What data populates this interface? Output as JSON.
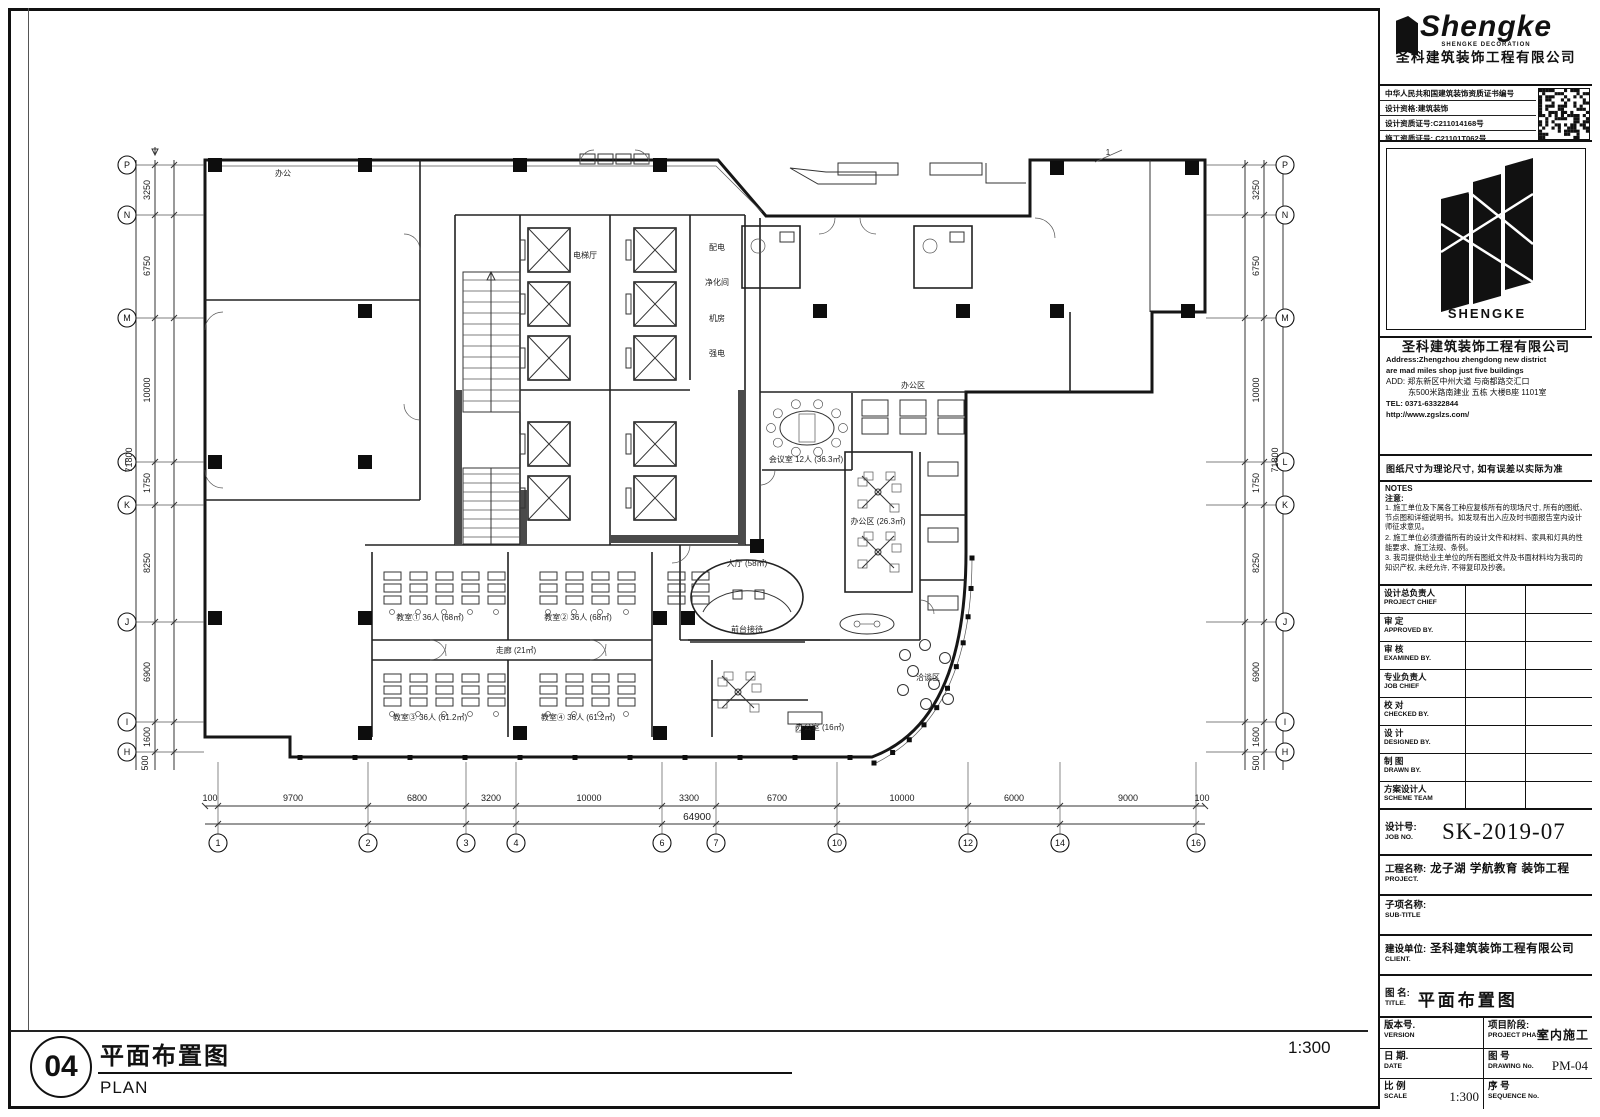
{
  "title_block": {
    "logo": {
      "brand": "Shengke",
      "sub": "SHENGKE DECORATION",
      "company": "圣科建筑装饰工程有限公司",
      "emblem_text": "SHENGKE"
    },
    "certs": {
      "line1": "中华人民共和国建筑装饰资质证书编号",
      "line2": "设计资格:建筑装饰",
      "line3": "设计资质证号:C211014168号",
      "line4": "施工资质证号: C21101T062号"
    },
    "info": {
      "company": "圣科建筑装饰工程有限公司",
      "addr_en1": "Address:Zhengzhou zhengdong new district",
      "addr_en2": "are mad miles shop just five buildings",
      "addr_cn1": "ADD: 郑东新区中州大道 与商都路交汇口",
      "addr_cn2": "东500米路南建业 五栋 大楼B座 1101室",
      "tel": "TEL: 0371-63322844",
      "web": "http://www.zgslzs.com/",
      "notice": "图纸尺寸为理论尺寸, 如有误差以实际为准"
    },
    "notes": {
      "title": "NOTES",
      "subtitle": "注意:",
      "items": [
        "1. 施工单位及下属各工种应复核所有的现场尺寸, 所有的图纸、节点图和详细说明书。如发现有出入应及时书面报告室内设计师征求意见。",
        "2. 施工单位必须遵循所有的设计文件和材料、家具和灯具的性能要求、施工法规、条例。",
        "3. 我司提供给业主单位的所有图纸文件及书面材料均为我司的知识产权, 未经允许, 不得复印及抄袭。"
      ]
    },
    "signatures": [
      {
        "cn": "设计总负责人",
        "en": "PROJECT CHIEF"
      },
      {
        "cn": "审  定",
        "en": "APPROVED BY."
      },
      {
        "cn": "审  核",
        "en": "EXAMINED BY."
      },
      {
        "cn": "专业负责人",
        "en": "JOB CHIEF"
      },
      {
        "cn": "校  对",
        "en": "CHECKED BY."
      },
      {
        "cn": "设  计",
        "en": "DESIGNED BY."
      },
      {
        "cn": "制  图",
        "en": "DRAWN BY."
      },
      {
        "cn": "方案设计人",
        "en": "SCHEME TEAM"
      }
    ],
    "job": {
      "no_cn": "设计号:",
      "no_en": "JOB NO.",
      "no_value": "SK-2019-07",
      "project_cn": "工程名称:",
      "project_en": "PROJECT.",
      "project_value": "龙子湖 学航教育 装饰工程",
      "subtitle_cn": "子项名称:",
      "subtitle_en": "SUB-TITLE",
      "client_cn": "建设单位:",
      "client_en": "CLIENT.",
      "client_value": "圣科建筑装饰工程有限公司",
      "title_cn": "图 名:",
      "title_en": "TITLE.",
      "title_value": "平面布置图"
    },
    "meta": {
      "version_cn": "版本号.",
      "version_en": "VERSION",
      "phase_cn": "项目阶段:",
      "phase_en": "PROJECT PHASE",
      "phase_value": "室内施工",
      "date_cn": "日 期.",
      "date_en": "DATE",
      "dwg_cn": "图 号",
      "dwg_en": "DRAWING No.",
      "dwg_value": "PM-04",
      "scale_cn": "比 例",
      "scale_en": "SCALE",
      "scale_value": "1:300",
      "seq_cn": "序 号",
      "seq_en": "SEQUENCE No."
    }
  },
  "footer": {
    "number": "04",
    "title_cn": "平面布置图",
    "title_en": "PLAN",
    "scale": "1:300"
  },
  "plan": {
    "grid_letters": [
      "P",
      "N",
      "M",
      "L",
      "K",
      "J",
      "I",
      "H"
    ],
    "left_dims": [
      "3250",
      "6750",
      "10000",
      "1750",
      "8250",
      "6900",
      "1600",
      "500"
    ],
    "overall_v": "71800",
    "bottom_bubbles": [
      "1",
      "2",
      "3",
      "4",
      "6",
      "7",
      "10",
      "12",
      "14",
      "16"
    ],
    "bottom_dims": [
      "100",
      "9700",
      "6800",
      "3200",
      "10000",
      "3300",
      "6700",
      "10000",
      "6000",
      "9000",
      "100"
    ],
    "overall_h": "64900",
    "labels": {
      "office_tl": "办公",
      "lift_lobby": "电梯厅",
      "core_room1": "配电",
      "core_room2": "净化间",
      "core_room3": "机房",
      "core_room4": "强电",
      "meeting": "会议室 12人 (36.3㎡)",
      "open_office": "办公区",
      "cluster_office": "办公区 (26.3㎡)",
      "reception": "前台接待",
      "hall": "大厅 (58㎡)",
      "corridor": "走廊 (21㎡)",
      "cls1": "教室① 36人 (68㎡)",
      "cls2": "教室② 36人 (68㎡)",
      "cls3": "教室③ 36人 (61.2㎡)",
      "cls4": "教室④ 36人 (61.2㎡)",
      "lounge": "洽谈区",
      "office_s": "办公室 (16㎡)",
      "rev": "1"
    }
  }
}
